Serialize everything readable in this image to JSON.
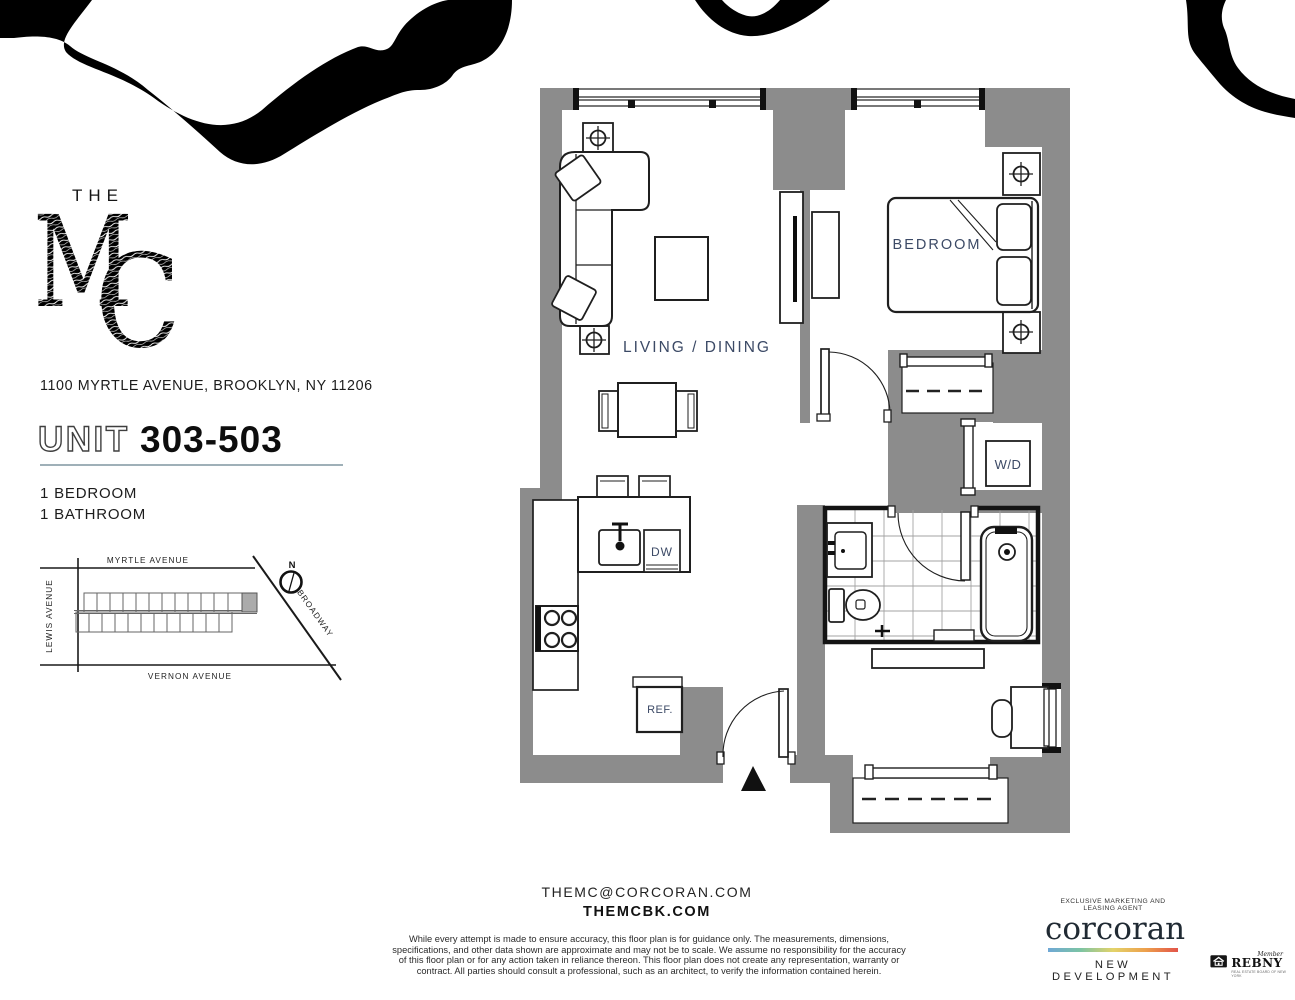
{
  "brand": {
    "the": "THE",
    "mc_m": "M",
    "mc_c": "C",
    "address": "1100 MYRTLE AVENUE, BROOKLYN, NY 11206"
  },
  "unit": {
    "label": "UNIT",
    "number": "303-503",
    "specs": [
      "1 BEDROOM",
      "1 BATHROOM"
    ]
  },
  "site_map": {
    "streets": {
      "top": "MYRTLE AVENUE",
      "left": "LEWIS AVENUE",
      "bottom": "VERNON AVENUE",
      "diagonal": "BROADWAY"
    },
    "compass": "N"
  },
  "floor_plan": {
    "rooms": {
      "living": "LIVING / DINING",
      "bedroom": "BEDROOM"
    },
    "appliances": {
      "washer_dryer": "W/D",
      "dishwasher": "DW",
      "refrigerator": "REF."
    }
  },
  "contact": {
    "email": "THEMC@CORCORAN.COM",
    "website": "THEMCBK.COM"
  },
  "disclaimer": {
    "lines": [
      "While every attempt is made to ensure accuracy, this floor plan is for guidance only. The measurements, dimensions,",
      "specifications, and other data shown are approximate and may not be to scale.  We assume no responsibility for the accuracy",
      "of this floor plan or for any action taken in reliance thereon. This floor plan does not create any representation, warranty or",
      "contract. All parties should consult a professional, such as an architect, to verify the information contained herein."
    ]
  },
  "footer": {
    "agent_line": "EXCLUSIVE MARKETING AND LEASING AGENT",
    "brand": "corcoran",
    "division": "NEW DEVELOPMENT",
    "rebny": {
      "member": "Member",
      "name": "REBNY",
      "tagline": "REAL ESTATE BOARD OF NEW YORK"
    }
  },
  "colors": {
    "wall": "#8c8c8c",
    "plan_label": "#3c4a66",
    "divider": "#9fb0b8",
    "gradient": [
      "#6fa8d6",
      "#7cc4a4",
      "#e3d36a",
      "#eda04c",
      "#e25449"
    ]
  }
}
